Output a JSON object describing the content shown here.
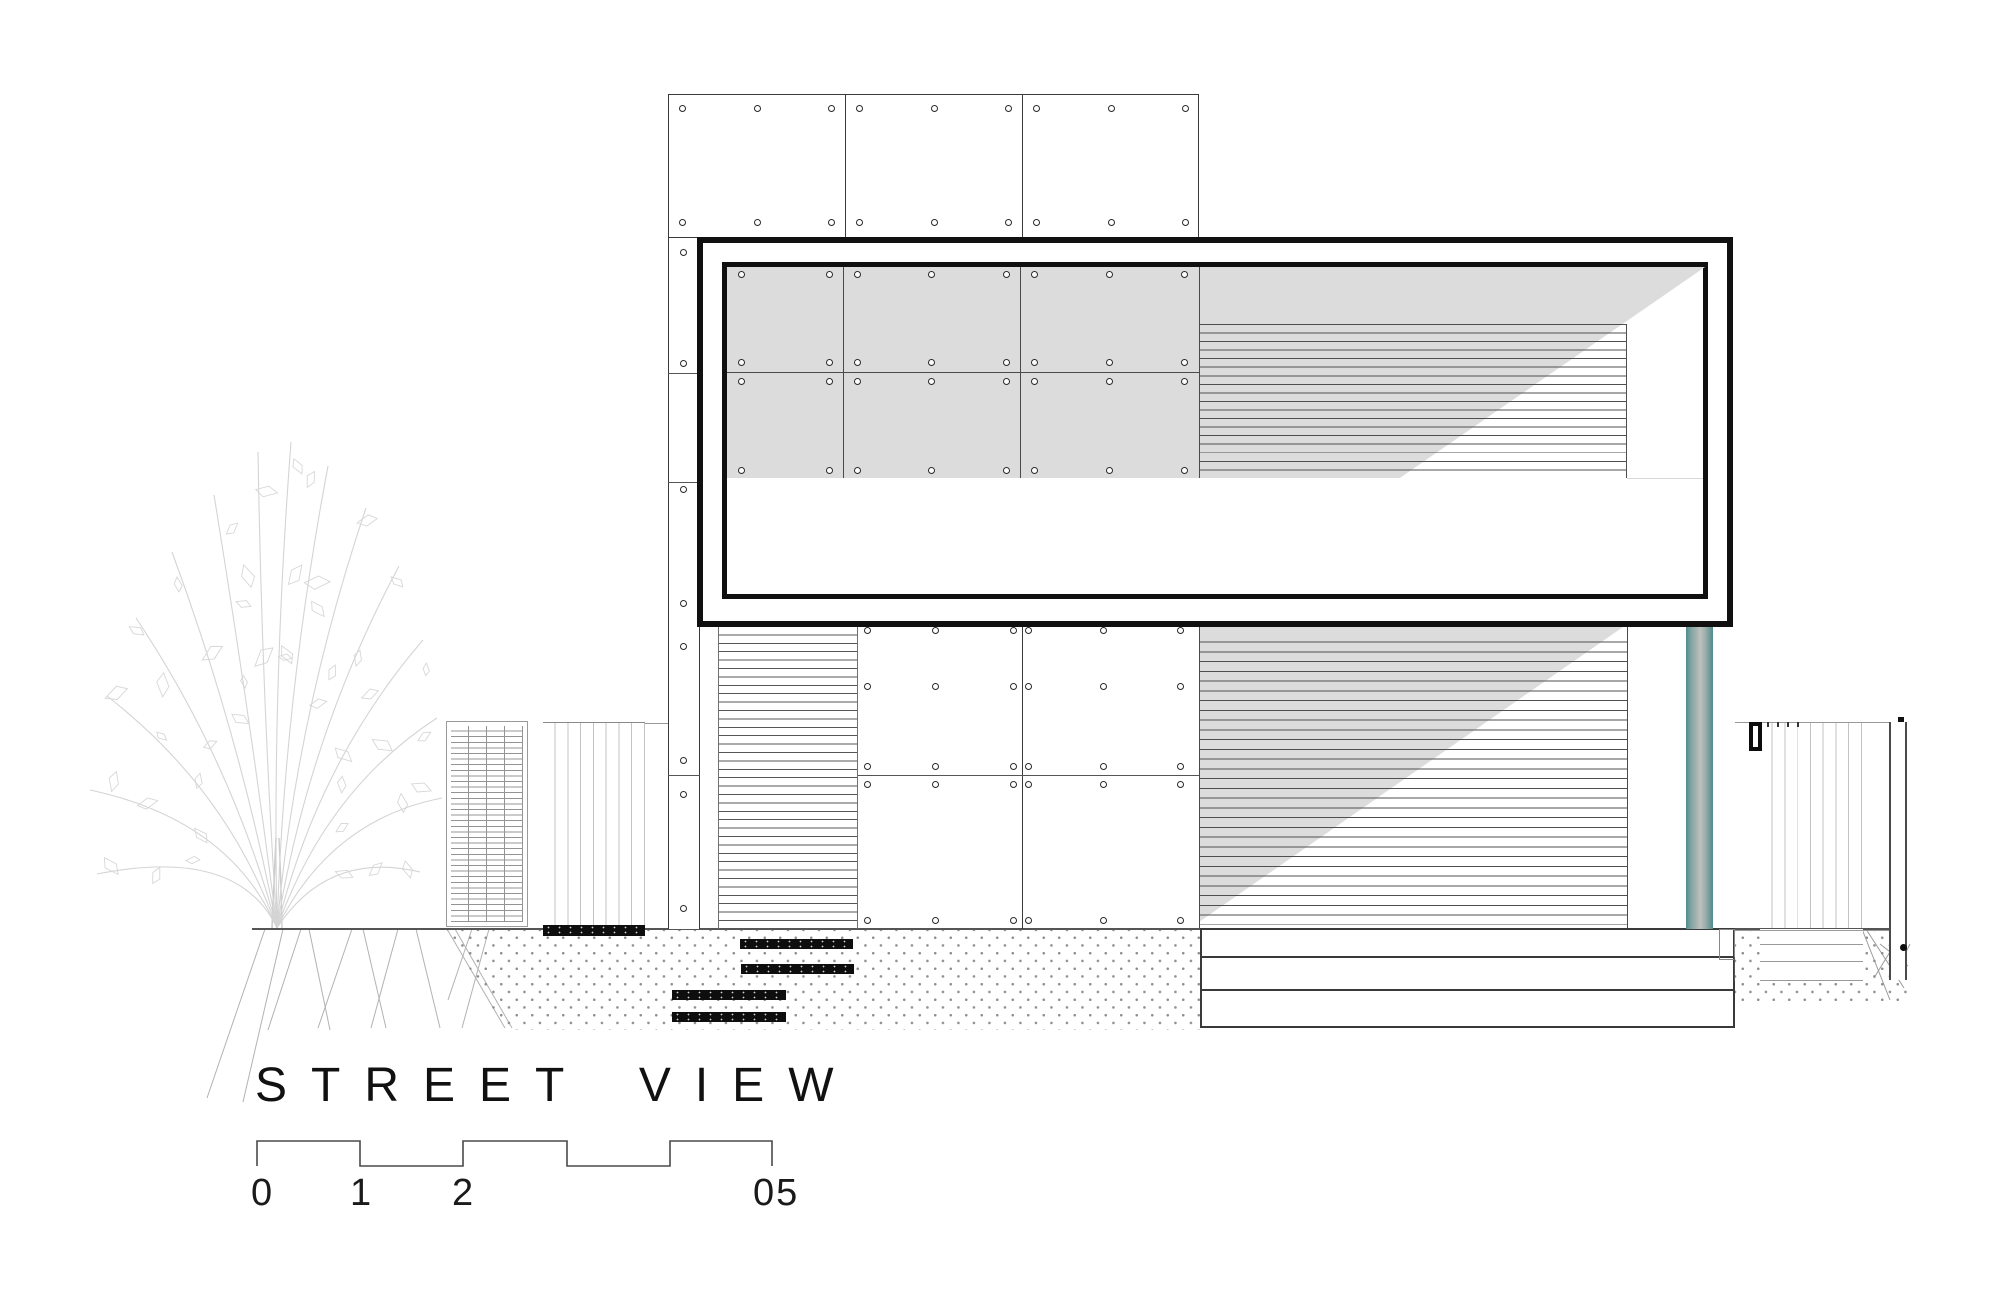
{
  "drawing": {
    "title": "STREET VIEW",
    "type": "architectural street elevation drawing"
  },
  "scale_bar": {
    "labels": [
      "0",
      "1",
      "2",
      "05"
    ]
  },
  "colors": {
    "glass_gray": "#dcdcdc",
    "frame_black": "#101010",
    "pipe_teal": "#4f8b8b",
    "line_dark": "#4a4a4a",
    "tree_gray": "#d6d6d6",
    "stipple_gray": "#8f8f8f",
    "step_black": "#0e0e0e"
  },
  "elements": {
    "tree": "ornamental tree sketch",
    "lattice_panel": "mesh gate panel",
    "left_fence": "vertical slat fence",
    "right_fence": "vertical slat fence with post",
    "window_box": "projecting framed window with louvers and glazing reflection",
    "facade": "bolted panel cladding",
    "louvers": "horizontal louver screens",
    "pipe": "rainwater downpipe",
    "steps": "entry steps",
    "deck": "side deck plinth"
  }
}
